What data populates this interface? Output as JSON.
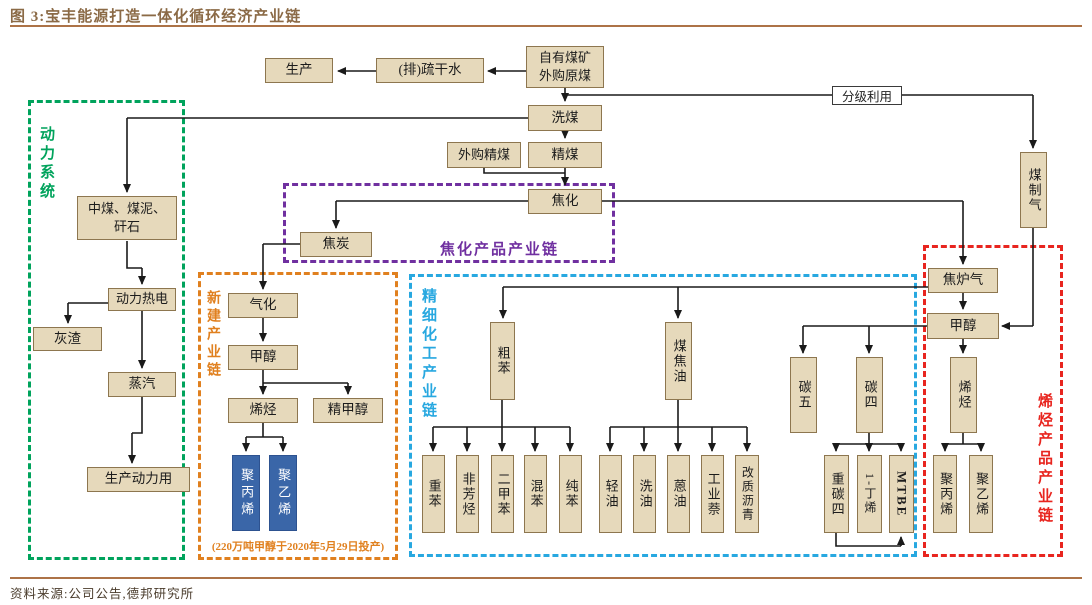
{
  "header": {
    "title": "图 3:宝丰能源打造一体化循环经济产业链"
  },
  "footer": {
    "source": "资料来源:公司公告,德邦研究所"
  },
  "colors": {
    "box_fill": "#e6d9bb",
    "box_border": "#8d764f",
    "blue_box": "#3a66a8",
    "flow_line": "#1a1a1a",
    "power_green": "#00a35c",
    "new_chain_orange": "#e0801f",
    "coking_purple": "#7030a0",
    "fine_chem_blue": "#28a8e0",
    "olefin_red": "#e8251f",
    "title_brown": "#8b6a46",
    "rule_brown": "#ad7347"
  },
  "groups": {
    "power": {
      "label": "动力系统"
    },
    "new_chain": {
      "label": "新建产业链",
      "note": "(220万吨甲醇于2020年5月29日投产)"
    },
    "coking_products": {
      "label": "焦化产品产业链"
    },
    "fine_chemical": {
      "label": "精细化工产业链"
    },
    "olefin_products": {
      "label": "烯烃产品产业链"
    }
  },
  "nodes": {
    "production": "生产",
    "drain_water": "(排)疏干水",
    "raw_coal": "自有煤矿外购原煤",
    "graded_use": "分级利用",
    "coal_washing": "洗煤",
    "purchased_clean_coal": "外购精煤",
    "clean_coal": "精煤",
    "coking": "焦化",
    "coke": "焦炭",
    "coal_to_gas": "煤制气",
    "middlings": "中煤、煤泥、矸石",
    "power_heat": "动力热电",
    "ash": "灰渣",
    "steam": "蒸汽",
    "production_power": "生产动力用",
    "gasification": "气化",
    "methanol_new": "甲醇",
    "olefin_new": "烯烃",
    "refined_methanol": "精甲醇",
    "pp_new": "聚丙烯",
    "pe_new": "聚乙烯",
    "crude_benzene": "粗苯",
    "coal_tar": "煤焦油",
    "heavy_benzene": "重苯",
    "non_aromatics": "非芳烃",
    "xylene": "二甲苯",
    "mixed_benzene": "混苯",
    "pure_benzene": "纯苯",
    "light_oil": "轻油",
    "wash_oil": "洗油",
    "anthracene_oil": "蒽油",
    "industrial_naphthalene": "工业萘",
    "modified_pitch": "改质沥青",
    "c5": "碳五",
    "c4": "碳四",
    "heavy_c4": "重碳四",
    "butene_1": "1-丁烯",
    "mtbe": "MTBE",
    "coke_oven_gas": "焦炉气",
    "methanol_olefin": "甲醇",
    "olefin_chain": "烯烃",
    "pp_olefin": "聚丙烯",
    "pe_olefin": "聚乙烯"
  }
}
